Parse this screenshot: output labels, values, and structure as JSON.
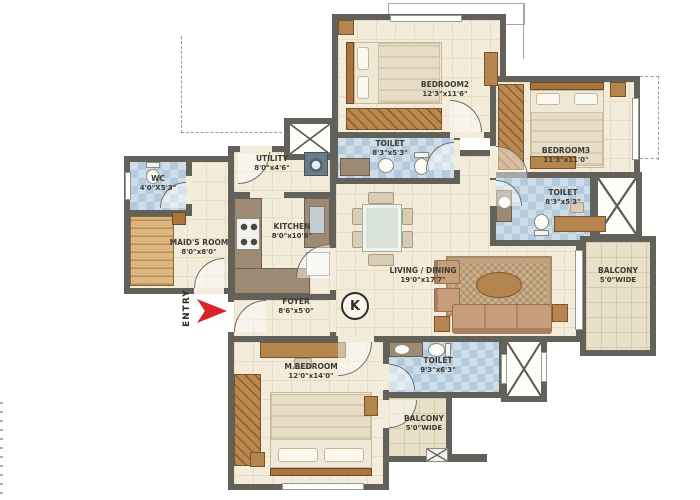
{
  "plan": {
    "entry_label": "ENTRY",
    "kitchen_marker": "K",
    "rooms": {
      "bedroom2": {
        "name": "BEDROOM2",
        "dims": "12'3\"x11'6\""
      },
      "bedroom3": {
        "name": "BEDROOM3",
        "dims": "11'3\"x11'0\""
      },
      "toilet2": {
        "name": "TOILET",
        "dims": "8'3\"x5'3\""
      },
      "toilet3": {
        "name": "TOILET",
        "dims": "8'3\"x5'3\""
      },
      "master_toilet": {
        "name": "TOILET",
        "dims": "9'3\"x6'3\""
      },
      "wc": {
        "name": "WC",
        "dims": "4'0\"X5'3\""
      },
      "maids_room": {
        "name": "MAID'S ROOM",
        "dims": "8'0\"x8'0\""
      },
      "utility": {
        "name": "UTILITY",
        "dims": "8'0\"x4'6\""
      },
      "kitchen": {
        "name": "KITCHEN",
        "dims": "8'0\"x10'6\""
      },
      "foyer": {
        "name": "FOYER",
        "dims": "8'6\"x5'0\""
      },
      "living_dining": {
        "name": "LIVING / DINING",
        "dims": "19'0\"x17'7\""
      },
      "master_bedroom": {
        "name": "M.BEDROOM",
        "dims": "12'0\"x14'0\""
      },
      "balcony_right": {
        "name": "BALCONY",
        "dims": "5'0\"WIDE"
      },
      "balcony_rear": {
        "name": "BALCONY",
        "dims": "5'0\"WIDE"
      }
    },
    "colors": {
      "wall": "#63625a",
      "floor": "#f3ecda",
      "toilet_tile": "#cfdde8",
      "balcony_tile": "#e9e0c8",
      "wood": "#b5854f",
      "entry_arrow": "#d8232a"
    }
  }
}
